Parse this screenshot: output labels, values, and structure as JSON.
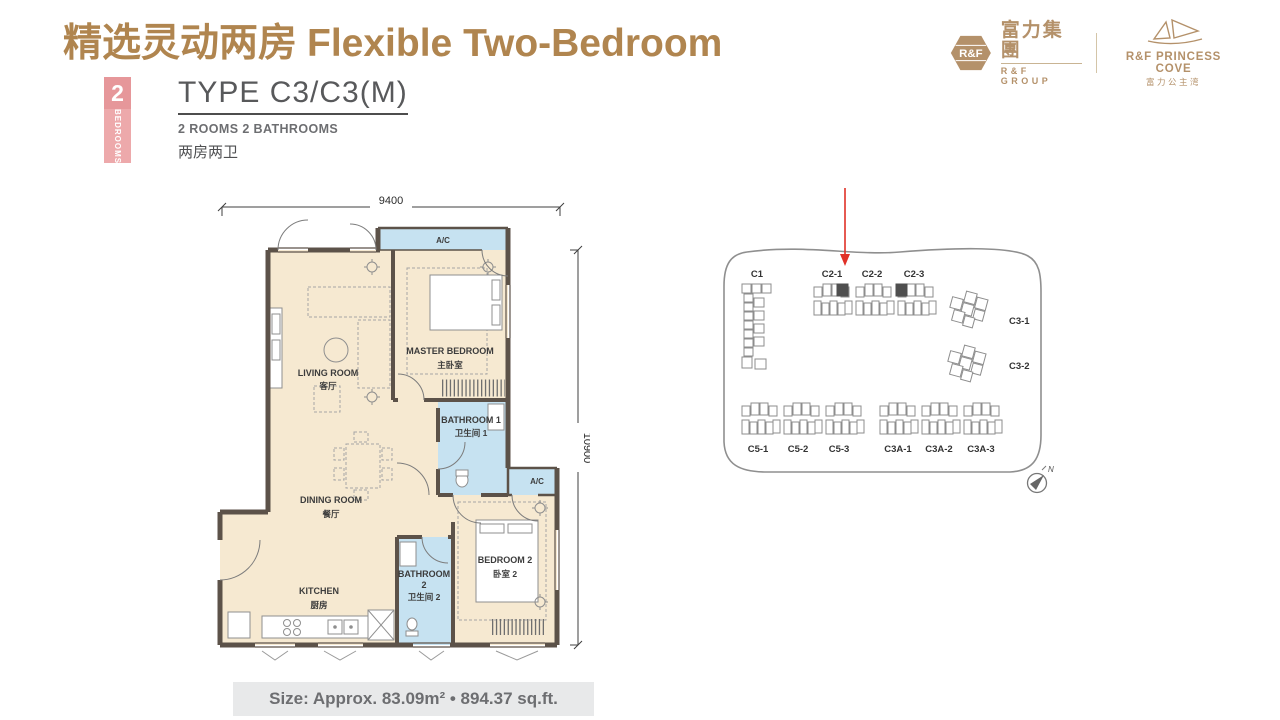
{
  "header": {
    "title_zh": "精选灵动两房",
    "title_en": "Flexible Two-Bedroom"
  },
  "logos": {
    "group": {
      "abbr": "R&F",
      "name_zh": "富力集團",
      "name_en": "R&F GROUP"
    },
    "cove": {
      "name_en": "R&F PRINCESS COVE",
      "name_zh": "富力公主湾"
    }
  },
  "unit": {
    "bedrooms_count": "2",
    "bedrooms_label": "BEDROOMS",
    "type": "TYPE C3/C3(M)",
    "rooms_en": "2 ROOMS 2 BATHROOMS",
    "rooms_zh": "两房两卫",
    "size_line": "Size: Approx. 83.09m²  •  894.37 sq.ft."
  },
  "floorplan": {
    "dim_top": "9400",
    "dim_right": "10900",
    "ac": "A/C",
    "rooms": {
      "living": {
        "en": "LIVING ROOM",
        "zh": "客厅"
      },
      "master": {
        "en": "MASTER BEDROOM",
        "zh": "主卧室"
      },
      "bath1": {
        "en": "BATHROOM 1",
        "zh": "卫生间 1"
      },
      "dining": {
        "en": "DINING ROOM",
        "zh": "餐厅"
      },
      "kitchen": {
        "en": "KITCHEN",
        "zh": "厨房"
      },
      "bath2": {
        "en": "BATHROOM",
        "num": "2",
        "zh": "卫生间 2"
      },
      "bed2": {
        "en": "BEDROOM 2",
        "zh": "卧室 2"
      }
    }
  },
  "siteplan": {
    "blocks": [
      "C1",
      "C2-1",
      "C2-2",
      "C2-3",
      "C3-1",
      "C3-2",
      "C5-1",
      "C5-2",
      "C5-3",
      "C3A-1",
      "C3A-2",
      "C3A-3"
    ],
    "north": "N"
  },
  "colors": {
    "accent_gold": "#b0854f",
    "badge_pink": "#e6979a",
    "wall": "#5c5249",
    "floor_beige": "#f6e9d1",
    "water_blue": "#c6e2f1",
    "arrow_red": "#e03127",
    "text_gray": "#6d6e71"
  }
}
